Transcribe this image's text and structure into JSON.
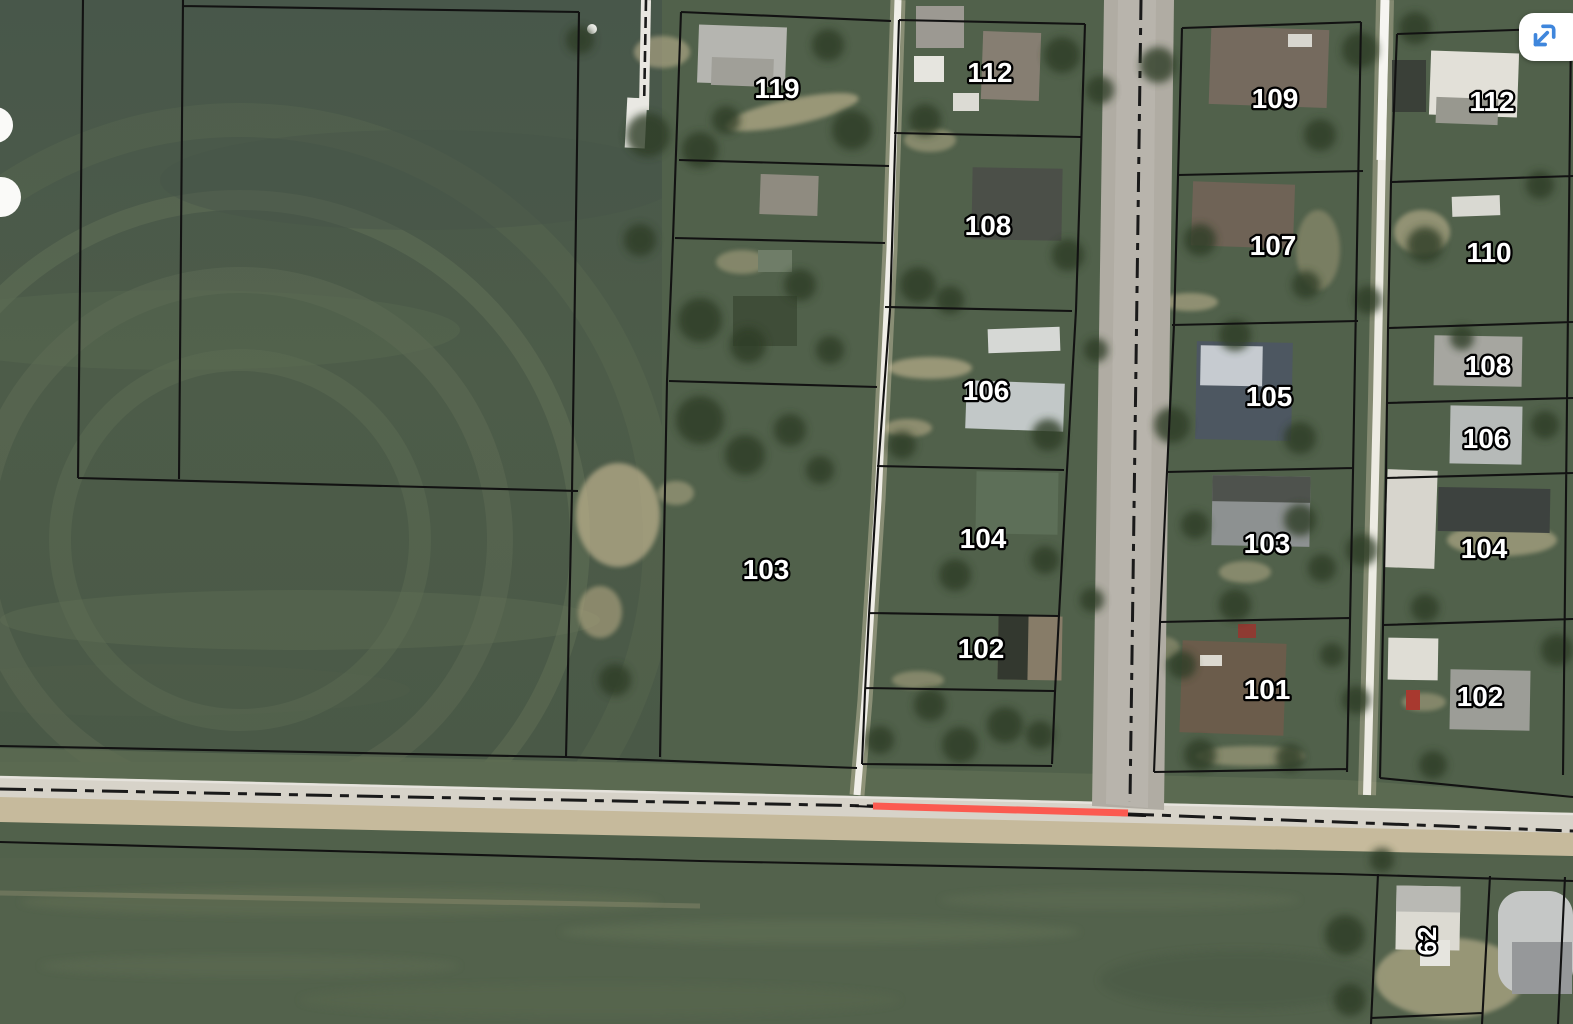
{
  "app": {
    "type": "gis-parcel-map-viewer",
    "base_layer": "satellite-imagery"
  },
  "map": {
    "label_style": {
      "fill": "#ffffff",
      "outline": "#000000"
    },
    "boundary_color": "#121212",
    "road_centerline_color": "#1a1a1a",
    "parcel_labels": [
      {
        "id": "block1-119",
        "text": "119",
        "x": 777,
        "y": 89,
        "rotate": 0
      },
      {
        "id": "block2-112",
        "text": "112",
        "x": 990,
        "y": 73,
        "rotate": 0
      },
      {
        "id": "block3-109",
        "text": "109",
        "x": 1275,
        "y": 99,
        "rotate": 0
      },
      {
        "id": "block4-112",
        "text": "112",
        "x": 1492,
        "y": 102,
        "rotate": 0
      },
      {
        "id": "block2-108",
        "text": "108",
        "x": 988,
        "y": 226,
        "rotate": 0
      },
      {
        "id": "block3-107",
        "text": "107",
        "x": 1273,
        "y": 246,
        "rotate": 0
      },
      {
        "id": "block4-110",
        "text": "110",
        "x": 1489,
        "y": 253,
        "rotate": 0
      },
      {
        "id": "block2-106",
        "text": "106",
        "x": 986,
        "y": 391,
        "rotate": 0
      },
      {
        "id": "block3-105",
        "text": "105",
        "x": 1269,
        "y": 397,
        "rotate": 0
      },
      {
        "id": "block4-108",
        "text": "108",
        "x": 1488,
        "y": 366,
        "rotate": 0
      },
      {
        "id": "block4-106",
        "text": "106",
        "x": 1486,
        "y": 439,
        "rotate": 0
      },
      {
        "id": "west-103",
        "text": "103",
        "x": 766,
        "y": 570,
        "rotate": 0
      },
      {
        "id": "block2-104",
        "text": "104",
        "x": 983,
        "y": 539,
        "rotate": 0
      },
      {
        "id": "block3-103",
        "text": "103",
        "x": 1267,
        "y": 544,
        "rotate": 0
      },
      {
        "id": "block4-104",
        "text": "104",
        "x": 1484,
        "y": 549,
        "rotate": 0
      },
      {
        "id": "block2-102",
        "text": "102",
        "x": 981,
        "y": 649,
        "rotate": 0
      },
      {
        "id": "block3-101",
        "text": "101",
        "x": 1267,
        "y": 690,
        "rotate": 0
      },
      {
        "id": "block4-102",
        "text": "102",
        "x": 1480,
        "y": 697,
        "rotate": 0
      },
      {
        "id": "south-62",
        "text": "62",
        "x": 1427,
        "y": 941,
        "rotate": -90
      }
    ],
    "highlight_segment": {
      "x1": 873,
      "y1": 806,
      "x2": 1128,
      "y2": 813,
      "color": "#fb5a50",
      "width": 7
    }
  },
  "controls": {
    "expand_button": {
      "icon": "collapse-diagonal-arrow-icon",
      "icon_color": "#3f86dc",
      "background": "#ffffff"
    }
  }
}
